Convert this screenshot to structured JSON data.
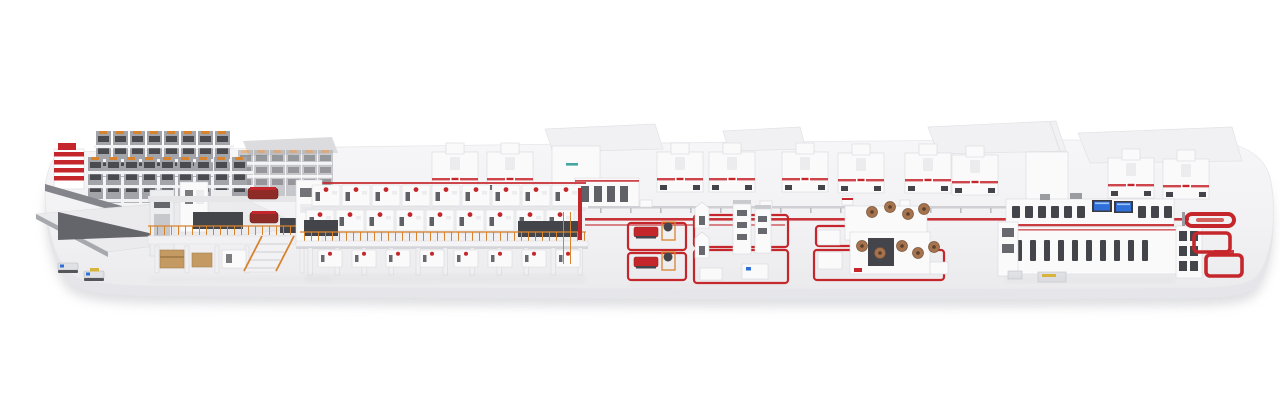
{
  "image_type": "3d-render",
  "subject": "complete industrial production line on white platform",
  "palette": {
    "bg": "#ffffff",
    "platform_top": "#f3f3f5",
    "platform_mid": "#eeeef1",
    "platform_front": "#e6e6ea",
    "floor_shadow": "#c7c8cd",
    "machine_white": "#fafafb",
    "machine_edge": "#d8d8dc",
    "machine_light": "#ececef",
    "slot_dark": "#44454b",
    "steel_gray": "#9b9ca2",
    "steel_dark": "#6b6c72",
    "accent_red": "#c5262b",
    "red_dark": "#8e2b26",
    "orange": "#d8832e",
    "wood_tan": "#c49a62",
    "copper": "#a5734d",
    "copper_dark": "#7b5439",
    "screen_blue": "#2e6fd8",
    "accent_yellow": "#d9b43a",
    "roof_gray": "#f1f1f4",
    "roof_edge": "#e2e2e6"
  }
}
